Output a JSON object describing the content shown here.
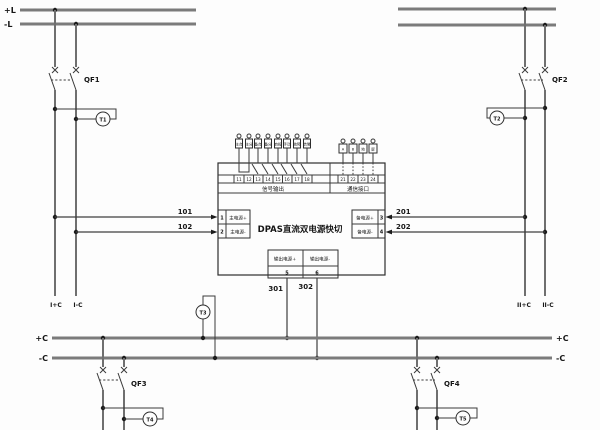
{
  "device": {
    "name": "DPAS直流双电源快切",
    "signal_section_label": "信号输出",
    "comm_section_label": "通信接口",
    "signal_terminals": [
      "11",
      "12",
      "13",
      "14",
      "15",
      "16",
      "17",
      "18"
    ],
    "signal_tags": [
      "主合",
      "主分",
      "备合",
      "备分",
      "自投",
      "手动",
      "故障",
      "告警"
    ],
    "comm_terminals": [
      "21",
      "22",
      "23",
      "24"
    ],
    "comm_tags": [
      "A",
      "B",
      "地",
      "屏"
    ],
    "main_in": {
      "plus_num": "1",
      "plus_label": "主电源+",
      "minus_num": "2",
      "minus_label": "主电源-"
    },
    "backup_in": {
      "plus_num": "3",
      "plus_label": "备电源+",
      "minus_num": "4",
      "minus_label": "备电源-"
    },
    "output": {
      "plus_num": "5",
      "plus_label": "输出电源+",
      "minus_num": "6",
      "minus_label": "输出电源-"
    }
  },
  "buses": {
    "top_left_pos": "+L",
    "top_left_neg": "-L",
    "ctrl_left_pos": "+C",
    "ctrl_left_neg": "-C",
    "ctrl_right_pos": "+C",
    "ctrl_right_neg": "-C"
  },
  "breakers": {
    "qf1": "QF1",
    "qf2": "QF2",
    "qf3": "QF3",
    "qf4": "QF4"
  },
  "monitors": {
    "t1": "T1",
    "t2": "T2",
    "t3": "T3",
    "t4": "T4",
    "t5": "T5"
  },
  "wires": {
    "w101": "101",
    "w102": "102",
    "w201": "201",
    "w202": "202",
    "w301": "301",
    "w302": "302"
  },
  "feeders": {
    "sec1_pos": "I+C",
    "sec1_neg": "I-C",
    "sec2_pos": "II+C",
    "sec2_neg": "II-C"
  }
}
